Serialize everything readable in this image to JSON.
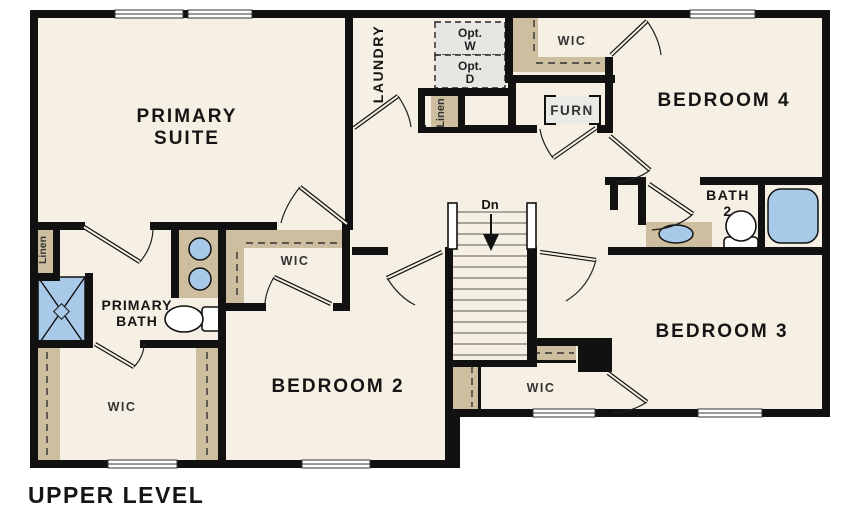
{
  "title": "UPPER LEVEL",
  "colors": {
    "floor": "#f6efe3",
    "walls": "#111111",
    "closet_shelf_tan": "#ccbe9e",
    "fixture_blue": "#a9c9e9",
    "optional_unit_gray": "#e6e6e3",
    "background": "#ffffff"
  },
  "rooms": {
    "primary_suite": {
      "line1": "PRIMARY",
      "line2": "SUITE"
    },
    "laundry": {
      "label": "LAUNDRY"
    },
    "opt_washer": {
      "line1": "Opt.",
      "line2": "W"
    },
    "opt_dryer": {
      "line1": "Opt.",
      "line2": "D"
    },
    "wic_top": {
      "label": "WIC"
    },
    "bedroom4": {
      "label": "BEDROOM 4"
    },
    "linen_top": {
      "label": "Linen"
    },
    "furnace": {
      "label": "FURN"
    },
    "bath2": {
      "line1": "BATH",
      "line2": "2"
    },
    "stairs": {
      "label": "Dn"
    },
    "wic_mid": {
      "label": "WIC"
    },
    "primary_bath": {
      "line1": "PRIMARY",
      "line2": "BATH"
    },
    "linen_left": {
      "label": "Linen"
    },
    "wic_left": {
      "label": "WIC"
    },
    "bedroom2": {
      "label": "BEDROOM 2"
    },
    "wic_bottom": {
      "label": "WIC"
    },
    "bedroom3": {
      "label": "BEDROOM 3"
    }
  }
}
